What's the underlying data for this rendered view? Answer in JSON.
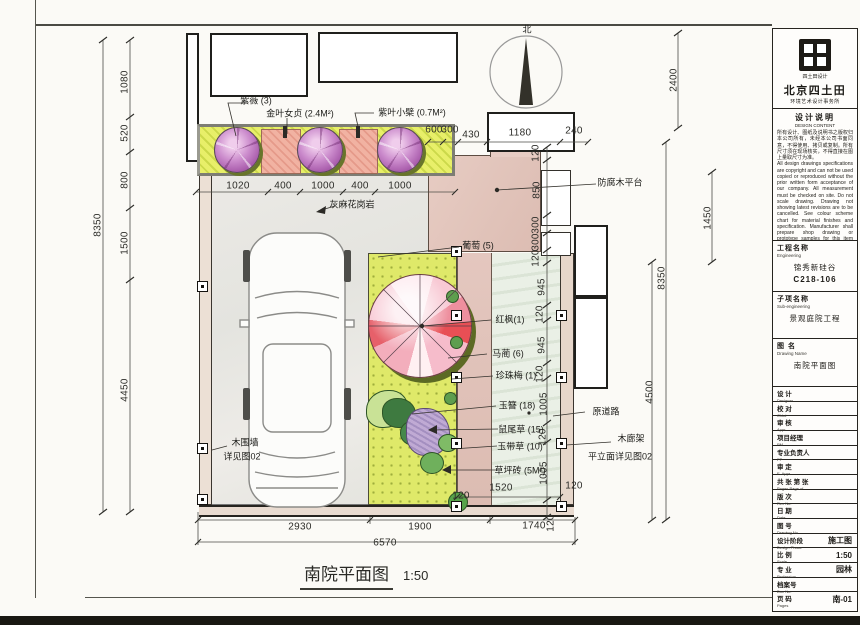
{
  "meta": {
    "drawing_title": "南院平面图",
    "drawing_scale": "1:50"
  },
  "compass": {
    "north_label": "北"
  },
  "plan": {
    "labels": [
      {
        "t": "北",
        "x": 527,
        "y": 29
      },
      {
        "t": "紫薇 (3)",
        "x": 256,
        "y": 100
      },
      {
        "t": "金叶女贞 (2.4M²)",
        "x": 300,
        "y": 113
      },
      {
        "t": "紫叶小檗 (0.7M²)",
        "x": 412,
        "y": 112
      },
      {
        "t": "灰麻花岗岩",
        "x": 352,
        "y": 204
      },
      {
        "t": "防腐木平台",
        "x": 620,
        "y": 182
      },
      {
        "t": "葡萄 (5)",
        "x": 478,
        "y": 245
      },
      {
        "t": "红枫(1)",
        "x": 510,
        "y": 319
      },
      {
        "t": "马蔺 (6)",
        "x": 508,
        "y": 353
      },
      {
        "t": "珍珠梅 (1)",
        "x": 516,
        "y": 375
      },
      {
        "t": "玉簪 (18)",
        "x": 517,
        "y": 405
      },
      {
        "t": "鼠尾草 (15)",
        "x": 521,
        "y": 429
      },
      {
        "t": "玉带草 (10)",
        "x": 520,
        "y": 446
      },
      {
        "t": "草坪砖 (5M²)",
        "x": 520,
        "y": 470
      },
      {
        "t": "原道路",
        "x": 606,
        "y": 411
      },
      {
        "t": "木廊架",
        "x": 631,
        "y": 438
      },
      {
        "t": "平立面详见图02",
        "x": 620,
        "y": 456
      },
      {
        "t": "木围墙",
        "x": 245,
        "y": 442
      },
      {
        "t": "详见图02",
        "x": 242,
        "y": 456
      }
    ],
    "dimensions": [
      {
        "t": "1080",
        "x": 125,
        "y": 82,
        "r": 1
      },
      {
        "t": "520",
        "x": 125,
        "y": 133,
        "r": 1
      },
      {
        "t": "800",
        "x": 125,
        "y": 180,
        "r": 1
      },
      {
        "t": "1500",
        "x": 125,
        "y": 243,
        "r": 1
      },
      {
        "t": "4450",
        "x": 125,
        "y": 390,
        "r": 1
      },
      {
        "t": "8350",
        "x": 98,
        "y": 225,
        "r": 1
      },
      {
        "t": "1020",
        "x": 238,
        "y": 186
      },
      {
        "t": "400",
        "x": 283,
        "y": 186
      },
      {
        "t": "1000",
        "x": 323,
        "y": 186
      },
      {
        "t": "400",
        "x": 360,
        "y": 186
      },
      {
        "t": "1000",
        "x": 400,
        "y": 186
      },
      {
        "t": "600",
        "x": 434,
        "y": 130
      },
      {
        "t": "300",
        "x": 450,
        "y": 130
      },
      {
        "t": "430",
        "x": 471,
        "y": 135
      },
      {
        "t": "1180",
        "x": 520,
        "y": 133
      },
      {
        "t": "240",
        "x": 574,
        "y": 131
      },
      {
        "t": "2400",
        "x": 674,
        "y": 80,
        "r": 1
      },
      {
        "t": "1450",
        "x": 708,
        "y": 218,
        "r": 1
      },
      {
        "t": "8350",
        "x": 662,
        "y": 278,
        "r": 1
      },
      {
        "t": "4500",
        "x": 650,
        "y": 392,
        "r": 1
      },
      {
        "t": "120",
        "x": 536,
        "y": 153,
        "r": 1
      },
      {
        "t": "850",
        "x": 537,
        "y": 190,
        "r": 1
      },
      {
        "t": "300",
        "x": 536,
        "y": 225,
        "r": 1
      },
      {
        "t": "300",
        "x": 536,
        "y": 242,
        "r": 1
      },
      {
        "t": "120",
        "x": 536,
        "y": 258,
        "r": 1
      },
      {
        "t": "945",
        "x": 542,
        "y": 287,
        "r": 1
      },
      {
        "t": "120",
        "x": 540,
        "y": 314,
        "r": 1
      },
      {
        "t": "945",
        "x": 542,
        "y": 345,
        "r": 1
      },
      {
        "t": "120",
        "x": 540,
        "y": 374,
        "r": 1
      },
      {
        "t": "1005",
        "x": 544,
        "y": 404,
        "r": 1
      },
      {
        "t": "120",
        "x": 543,
        "y": 437,
        "r": 1
      },
      {
        "t": "1005",
        "x": 544,
        "y": 473,
        "r": 1
      },
      {
        "t": "120",
        "x": 551,
        "y": 523,
        "r": 1
      },
      {
        "t": "1520",
        "x": 501,
        "y": 488
      },
      {
        "t": "120",
        "x": 461,
        "y": 496
      },
      {
        "t": "120",
        "x": 574,
        "y": 486
      },
      {
        "t": "2930",
        "x": 300,
        "y": 527
      },
      {
        "t": "1900",
        "x": 420,
        "y": 527
      },
      {
        "t": "1740",
        "x": 534,
        "y": 526
      },
      {
        "t": "6570",
        "x": 385,
        "y": 543
      }
    ]
  },
  "title_block": {
    "logo_caption": "四土田设计",
    "company": "北京四土田",
    "company_sub": "环境艺术设计事务所",
    "notes_header": "设计说明",
    "notes_header_en": "DESIGN CONTENT",
    "notes_cn": "所有设计、图纸及说明书之版权归本公司所有，未经本公司书面同意，不得使用、拷贝或复制。所有尺寸须在现场核实，不得直接在图上量取尺寸为准。",
    "notes_en": "All design drawings specifications are copyright and can not be used copied or reproduced without the prior written form acceptance of our company. All measurement must be checked on site. Do not scale drawing. Drawing not showing latest revisions are to be cancelled. See colour scheme chart for material finishes and specification. Manufacturer shall prepare shop drawing or prototype samples for this item and submit them to the designer for checking and approval.",
    "sections": [
      {
        "label": "工程名称",
        "label_en": "Engineering",
        "value": "锦秀新硅谷",
        "value2": "C218-106"
      },
      {
        "label": "子项名称",
        "label_en": "Sub-engineering",
        "value": "景观庭院工程"
      },
      {
        "label": "图  名",
        "label_en": "Drawing Name",
        "value": "南院平面图"
      }
    ],
    "rows": [
      {
        "label": "设 计",
        "en": "Designer",
        "value": ""
      },
      {
        "label": "校 对",
        "en": "Chkd",
        "value": ""
      },
      {
        "label": "审 核",
        "en": "Appr",
        "value": ""
      },
      {
        "label": "项目经理",
        "en": "PM",
        "value": ""
      },
      {
        "label": "专业负责人",
        "en": "PP",
        "value": ""
      },
      {
        "label": "审 定",
        "en": "E. Appr",
        "value": ""
      },
      {
        "label": "共  张  第  张",
        "en": "Pages    Page   of",
        "value": ""
      },
      {
        "label": "版 次",
        "en": "Rev No.",
        "value": ""
      },
      {
        "label": "日 期",
        "en": "Date",
        "value": ""
      },
      {
        "label": "图 号",
        "en": "Drawing No.",
        "value": ""
      },
      {
        "label": "设计阶段",
        "en": "Design Phase",
        "value": "施工图"
      },
      {
        "label": "比 例",
        "en": "Scale",
        "value": "1:50"
      },
      {
        "label": "专 业",
        "en": "Profession",
        "value": "园林"
      },
      {
        "label": "档案号",
        "en": "Doc No.",
        "value": ""
      },
      {
        "label": "页 码",
        "en": "Pages",
        "value": "南-01"
      }
    ]
  }
}
